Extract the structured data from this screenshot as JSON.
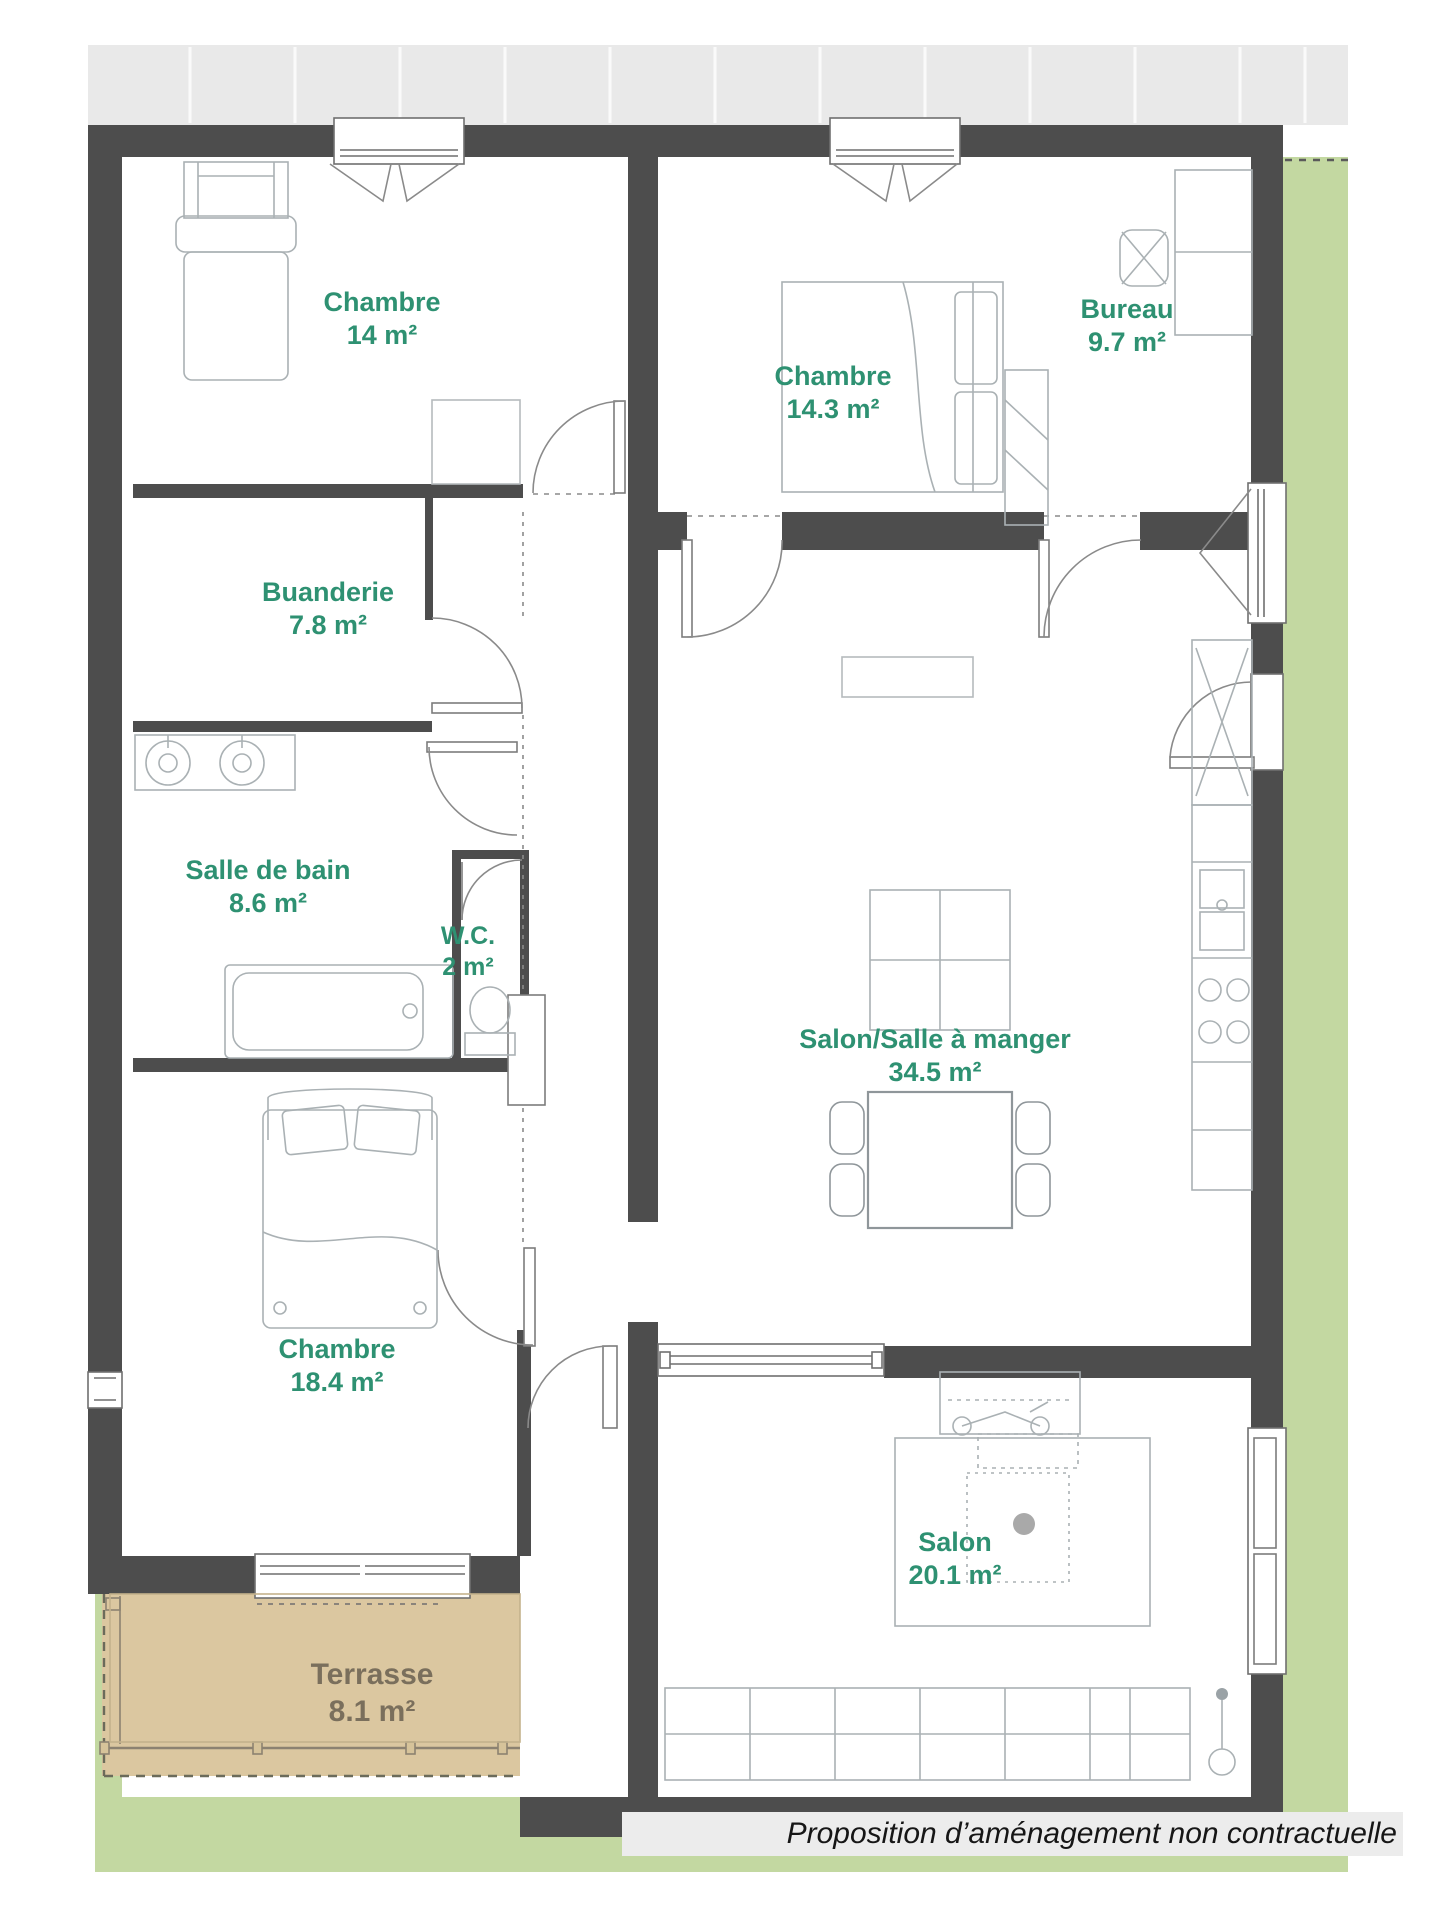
{
  "plan": {
    "title": "Plan d'appartement",
    "rooms": [
      {
        "id": "chambre-14",
        "name": "Chambre",
        "area": "14 m²"
      },
      {
        "id": "chambre-14-3",
        "name": "Chambre",
        "area": "14.3 m²"
      },
      {
        "id": "bureau",
        "name": "Bureau",
        "area": "9.7 m²"
      },
      {
        "id": "buanderie",
        "name": "Buanderie",
        "area": "7.8 m²"
      },
      {
        "id": "salle-de-bain",
        "name": "Salle de bain",
        "area": "8.6 m²"
      },
      {
        "id": "wc",
        "name": "W.C.",
        "area": "2 m²"
      },
      {
        "id": "salon-salle-a-manger",
        "name": "Salon/Salle à manger",
        "area": "34.5 m²"
      },
      {
        "id": "chambre-18-4",
        "name": "Chambre",
        "area": "18.4 m²"
      },
      {
        "id": "salon",
        "name": "Salon",
        "area": "20.1 m²"
      },
      {
        "id": "terrasse",
        "name": "Terrasse",
        "area": "8.1 m²"
      }
    ],
    "footer": "Proposition d’aménagement non contractuelle",
    "colors": {
      "wall": "#4d4d4d",
      "room_label": "#2e9172",
      "terrace_fill": "#dbc7a0",
      "terrace_text": "#7a6f5c",
      "garden": "#c3d8a1",
      "sidewalk": "#e9e9e9",
      "footer_bg": "#ececec",
      "line": "#9aa2a6"
    }
  }
}
